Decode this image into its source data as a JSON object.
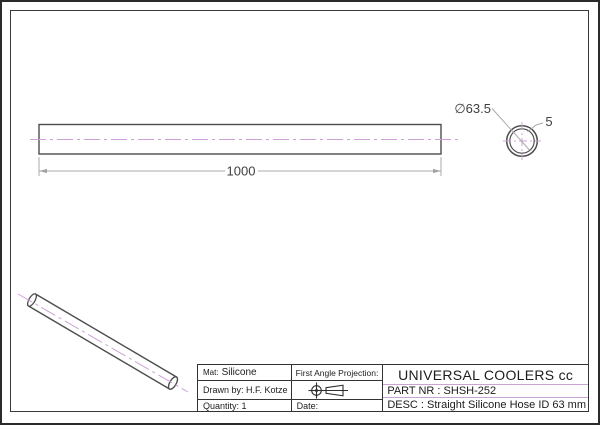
{
  "drawing": {
    "dimensions": {
      "length": "1000",
      "diameter": "∅63.5",
      "wall_thickness": "5"
    },
    "title_block": {
      "material_label": "Mat:",
      "material_value": "Silicone",
      "drawn_by": "Drawn by: H.F. Kotze",
      "quantity": "Quantity: 1",
      "projection_label": "First Angle Projection:",
      "date_label": "Date:",
      "company": "UNIVERSAL COOLERS cc",
      "part_nr": "PART NR : SHSH-252",
      "description": "DESC : Straight Silicone Hose ID 63 mm"
    },
    "icons": {
      "projection_symbol": "first-angle-projection"
    },
    "colors": {
      "outline": "#4d4d4d",
      "dimension": "#ababab",
      "centerline": "#cfa0d8",
      "title_block_divider": "#c9a3d4"
    }
  }
}
